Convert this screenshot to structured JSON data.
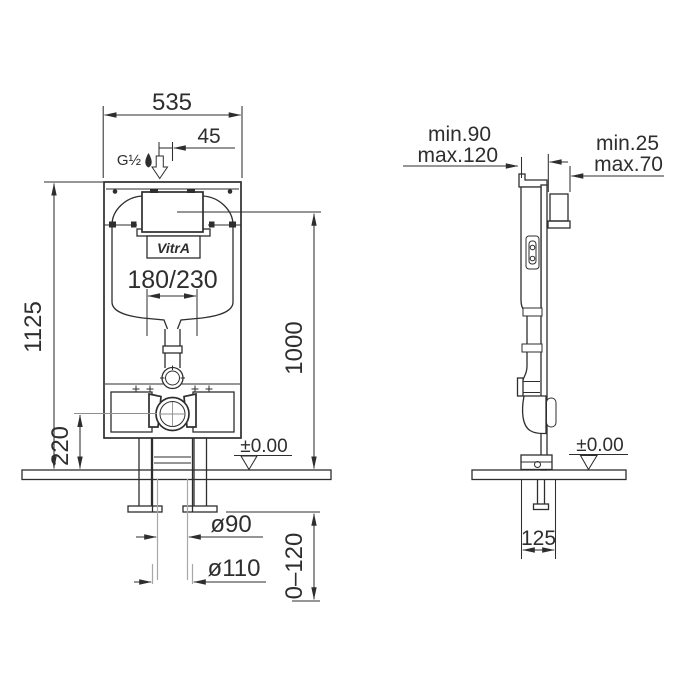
{
  "drawing": {
    "brand": "VitrA",
    "front": {
      "width": "535",
      "inlet_offset": "45",
      "inlet_thread": "G½",
      "overall_height": "1125",
      "actuation_height": "1000",
      "outlet_height": "220",
      "flush_plate_range": "180/230",
      "floor_level": "±0.00",
      "drain_inner": "ø90",
      "drain_outer": "ø110",
      "depth_adjust": "0–120"
    },
    "side": {
      "depth_min": "min.90",
      "depth_max": "max.120",
      "finish_min": "min.25",
      "finish_max": "max.70",
      "base_depth": "125",
      "floor_level": "±0.00"
    },
    "colors": {
      "line": "#2e2e2e",
      "construction_line": "#a8a8a8",
      "paper": "#ffffff"
    }
  }
}
